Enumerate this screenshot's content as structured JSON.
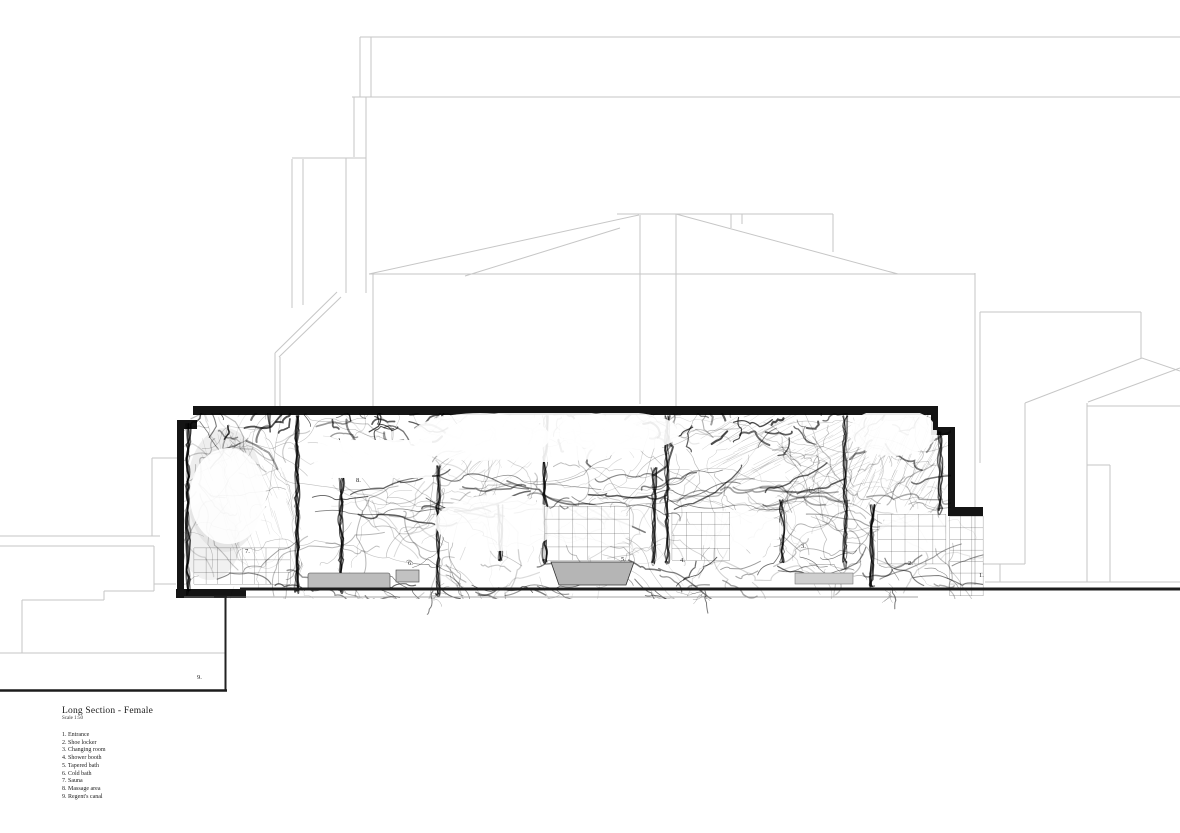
{
  "drawing": {
    "type": "architectural-section",
    "title": "Long Section - Female",
    "scale_note": "Scale 1:50",
    "legend": [
      "1. Entrance",
      "2. Shoe locker",
      "3. Changing room",
      "4. Shower booth",
      "5. Tapered bath",
      "6. Cold bath",
      "7. Sauna",
      "8. Massage area",
      "9. Regent's canal"
    ],
    "plan_labels": [
      {
        "text": "1.",
        "x": 979,
        "y": 577
      },
      {
        "text": "2.",
        "x": 908,
        "y": 565
      },
      {
        "text": "3.",
        "x": 801,
        "y": 548
      },
      {
        "text": "4.",
        "x": 680,
        "y": 562
      },
      {
        "text": "5.",
        "x": 621,
        "y": 561
      },
      {
        "text": "6.",
        "x": 408,
        "y": 565
      },
      {
        "text": "7.",
        "x": 245,
        "y": 553
      },
      {
        "text": "8.",
        "x": 356,
        "y": 482
      },
      {
        "text": "9.",
        "x": 197,
        "y": 679
      }
    ],
    "colors": {
      "paper": "#ffffff",
      "context_line": "#c6c6c6",
      "ink": "#141414",
      "ground": "#1c1c1c",
      "label": "#222222",
      "tub_fill": "#b5b5b5",
      "bench_fill": "#bcbcbc",
      "wash": "#cfcfcf"
    }
  }
}
